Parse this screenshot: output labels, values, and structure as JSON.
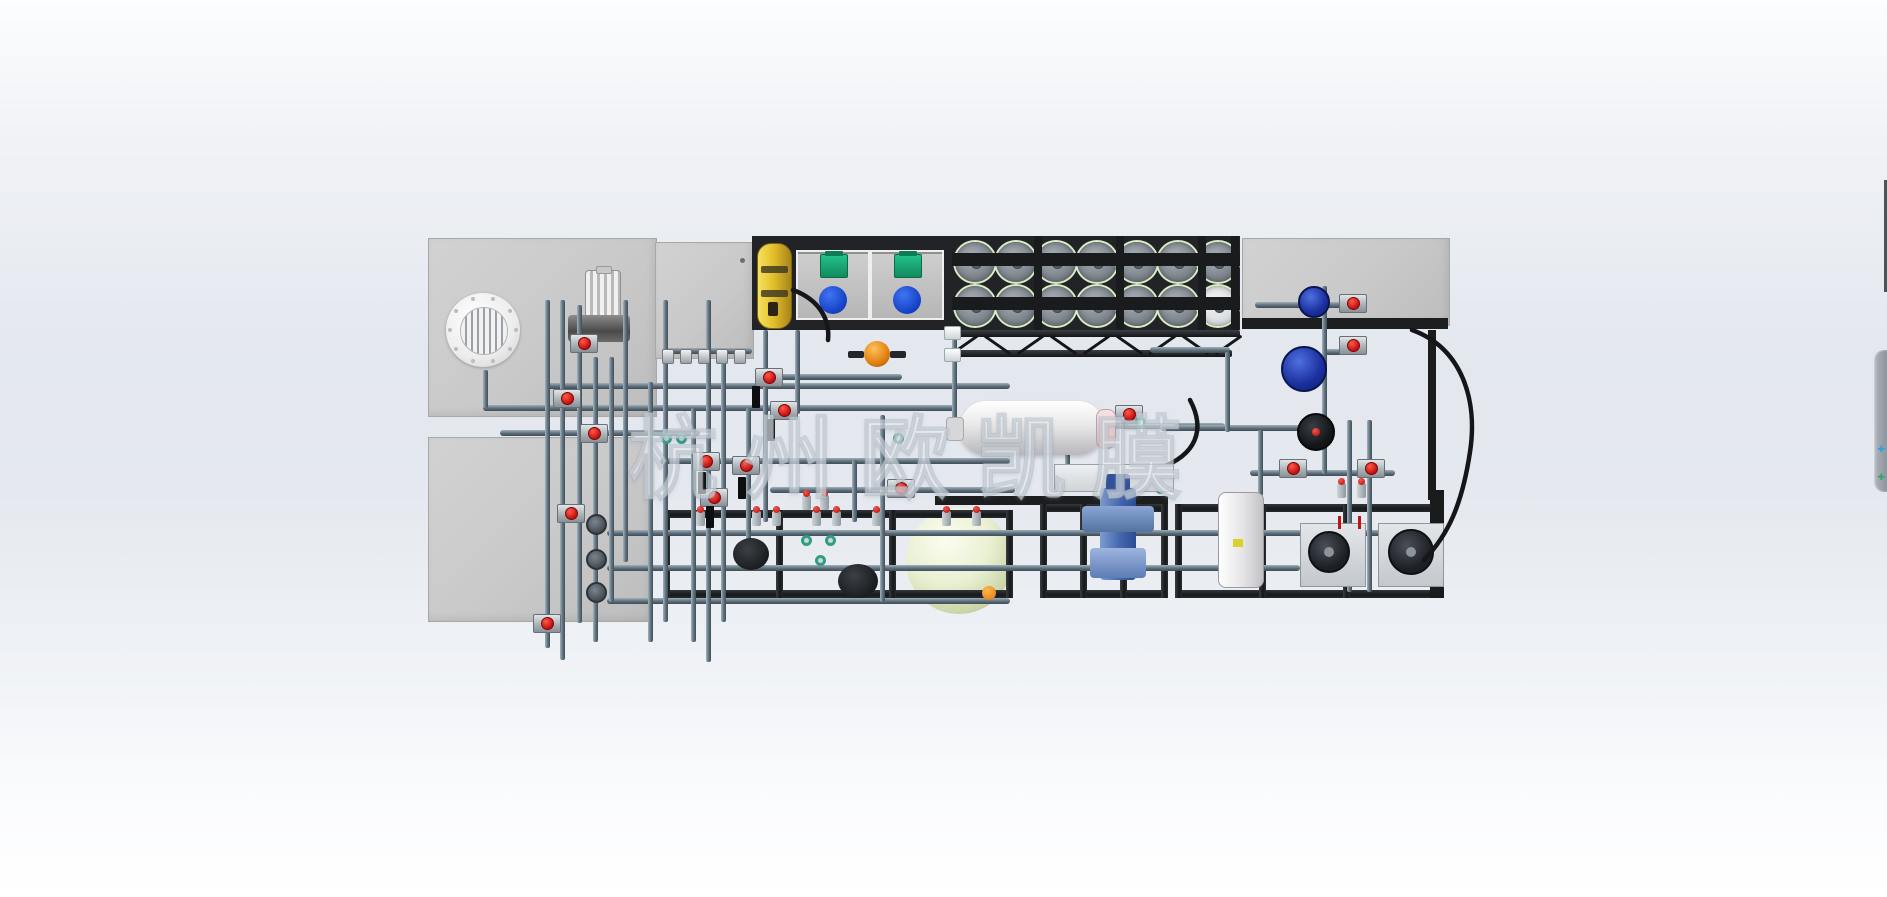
{
  "watermark": {
    "text": "杭州欧凯膜"
  },
  "ui": {
    "side_tab": {
      "icons": [
        {
          "name": "expand-blue-icon",
          "glyph": "✚",
          "color": "#2e9fe6"
        },
        {
          "name": "expand-green-icon",
          "glyph": "✚",
          "color": "#2fa85e"
        }
      ]
    }
  },
  "palette": {
    "background_top": "#fcfdfe",
    "background_mid": "#e3e7ee",
    "panel_gray": "#c9c9c9",
    "frame_black": "#17191b",
    "pipe_steel": "#5f707c",
    "valve_red": "#c40f0f",
    "teal_fitting": "#2f9e86",
    "dosing_green": "#128a5e",
    "lid_blue": "#1440c4",
    "cylinder_yellow": "#e3c02b",
    "pump_blue": "#1a2f9e",
    "sphere_green": "#e9f0d2",
    "orange_valve": "#e07f12"
  },
  "scene": {
    "panels": [
      {
        "n": "clarifier-panel",
        "x": 428,
        "y": 238,
        "w": 227,
        "h": 177
      },
      {
        "n": "storage-panel",
        "x": 428,
        "y": 437,
        "w": 222,
        "h": 183
      },
      {
        "n": "control-cabinet",
        "x": 655,
        "y": 242,
        "w": 97,
        "h": 115
      },
      {
        "n": "top-right-panel",
        "x": 1242,
        "y": 238,
        "w": 206,
        "h": 86
      }
    ],
    "bands": [
      {
        "n": "equipment-band",
        "x": 752,
        "y": 236,
        "w": 488,
        "h": 94,
        "c": "#212326"
      },
      {
        "n": "panel-bottom-strip",
        "x": 1242,
        "y": 318,
        "w": 206,
        "h": 11,
        "c": "#1c1e20"
      },
      {
        "n": "mid-top-rail",
        "x": 935,
        "y": 496,
        "w": 233,
        "h": 9,
        "c": "#1b1d1f"
      }
    ],
    "frames": [
      {
        "n": "skid-frame-left",
        "x": 663,
        "y": 510,
        "w": 350,
        "h": 88
      },
      {
        "n": "skid-frame-mid",
        "x": 1040,
        "y": 504,
        "w": 128,
        "h": 94
      },
      {
        "n": "skid-frame-right",
        "x": 1175,
        "y": 504,
        "w": 262,
        "h": 94
      }
    ],
    "rails": [
      [
        952,
        330,
        288
      ],
      [
        952,
        350,
        280
      ]
    ],
    "hose_row": {
      "x0": 963,
      "y": 329,
      "count": 9,
      "step": 33
    },
    "membrane_rack": {
      "x": 952,
      "y": 236,
      "w": 288,
      "h": 94,
      "rows": 2,
      "cols": 7,
      "disc": 40,
      "step": 40.5,
      "row_tops": [
        242,
        286
      ]
    },
    "rack_beams": [
      [
        952,
        253,
        288,
        13
      ],
      [
        952,
        297,
        288,
        13
      ]
    ],
    "rack_struts": [
      1034,
      1116,
      1198,
      1231
    ],
    "pipes_h": [
      [
        483,
        405,
        472
      ],
      [
        545,
        383,
        465
      ],
      [
        500,
        430,
        200
      ],
      [
        660,
        458,
        350
      ],
      [
        607,
        530,
        828
      ],
      [
        607,
        565,
        693
      ],
      [
        607,
        598,
        403
      ],
      [
        770,
        487,
        245
      ],
      [
        762,
        374,
        140
      ],
      [
        1105,
        423,
        120
      ],
      [
        1150,
        347,
        80
      ],
      [
        1160,
        425,
        140
      ],
      [
        1250,
        470,
        145
      ],
      [
        1255,
        302,
        100
      ],
      [
        1325,
        349,
        42
      ],
      [
        662,
        348,
        90
      ]
    ],
    "pipes_v": [
      [
        483,
        370,
        38
      ],
      [
        545,
        300,
        348
      ],
      [
        560,
        300,
        360
      ],
      [
        577,
        305,
        318
      ],
      [
        593,
        357,
        285
      ],
      [
        609,
        357,
        245
      ],
      [
        623,
        300,
        262
      ],
      [
        648,
        382,
        260
      ],
      [
        663,
        300,
        322
      ],
      [
        691,
        408,
        234
      ],
      [
        706,
        300,
        362
      ],
      [
        721,
        357,
        265
      ],
      [
        746,
        408,
        154
      ],
      [
        763,
        330,
        192
      ],
      [
        795,
        330,
        84
      ],
      [
        852,
        460,
        62
      ],
      [
        880,
        415,
        187
      ],
      [
        952,
        332,
        92
      ],
      [
        1065,
        430,
        44
      ],
      [
        1225,
        352,
        80
      ],
      [
        1322,
        286,
        188
      ],
      [
        1347,
        420,
        172
      ],
      [
        1367,
        420,
        172
      ],
      [
        1258,
        430,
        66
      ]
    ],
    "dark_bars": [
      [
        1428,
        330,
        8,
        170
      ],
      [
        1430,
        490,
        14,
        108
      ]
    ],
    "valves": [
      [
        583,
        342
      ],
      [
        566,
        397
      ],
      [
        593,
        432
      ],
      [
        768,
        376
      ],
      [
        783,
        409
      ],
      [
        705,
        460
      ],
      [
        745,
        464
      ],
      [
        713,
        496
      ],
      [
        570,
        512
      ],
      [
        900,
        487
      ],
      [
        1128,
        413
      ],
      [
        1292,
        467
      ],
      [
        1370,
        467
      ],
      [
        1128,
        556
      ],
      [
        1244,
        560
      ],
      [
        1352,
        302
      ],
      [
        1352,
        344
      ],
      [
        546,
        622
      ]
    ],
    "mini_valves": [
      [
        700,
        518
      ],
      [
        756,
        518
      ],
      [
        776,
        518
      ],
      [
        816,
        518
      ],
      [
        836,
        518
      ],
      [
        876,
        518
      ],
      [
        946,
        518
      ],
      [
        976,
        518
      ],
      [
        1341,
        490
      ],
      [
        1361,
        490
      ],
      [
        806,
        502
      ],
      [
        824,
        502
      ]
    ],
    "teal_fittings": [
      [
        666,
        438
      ],
      [
        681,
        438
      ],
      [
        806,
        540
      ],
      [
        830,
        540
      ],
      [
        1140,
        422
      ],
      [
        898,
        438
      ],
      [
        1160,
        488
      ],
      [
        820,
        560
      ]
    ],
    "flanges": [
      [
        596,
        524
      ],
      [
        596,
        559
      ],
      [
        596,
        592
      ]
    ],
    "brackets": [
      [
        752,
        386
      ],
      [
        767,
        419
      ],
      [
        698,
        472
      ],
      [
        738,
        477
      ],
      [
        706,
        506
      ]
    ],
    "cab_nubs": {
      "x0": 662,
      "y": 349,
      "count": 5,
      "step": 18
    },
    "bullets": {
      "x0": 1060,
      "y": 468,
      "count": 9,
      "step": 12
    },
    "red_ticks": [
      [
        1338,
        516
      ],
      [
        1358,
        516
      ]
    ],
    "wconns": [
      [
        944,
        326
      ],
      [
        944,
        348
      ]
    ],
    "dark_pumps": [
      [
        733,
        538,
        36,
        32
      ],
      [
        838,
        564,
        40,
        34
      ]
    ],
    "pump_bases": [
      [
        1300,
        523
      ],
      [
        1378,
        523
      ]
    ],
    "black_pumps": [
      [
        1308,
        531,
        42
      ],
      [
        1388,
        529,
        46
      ]
    ],
    "blue_pumps": [
      [
        1298,
        286,
        32
      ],
      [
        1281,
        346,
        46
      ]
    ],
    "ink_pump": [
      1297,
      413
    ],
    "hoses_svg": [
      "M 1412 330 C 1462 348 1478 400 1470 452 C 1462 505 1448 535 1424 560",
      "M 1190 400 C 1206 430 1196 455 1160 468",
      "M 793 290 C 820 300 830 320 828 340"
    ]
  }
}
